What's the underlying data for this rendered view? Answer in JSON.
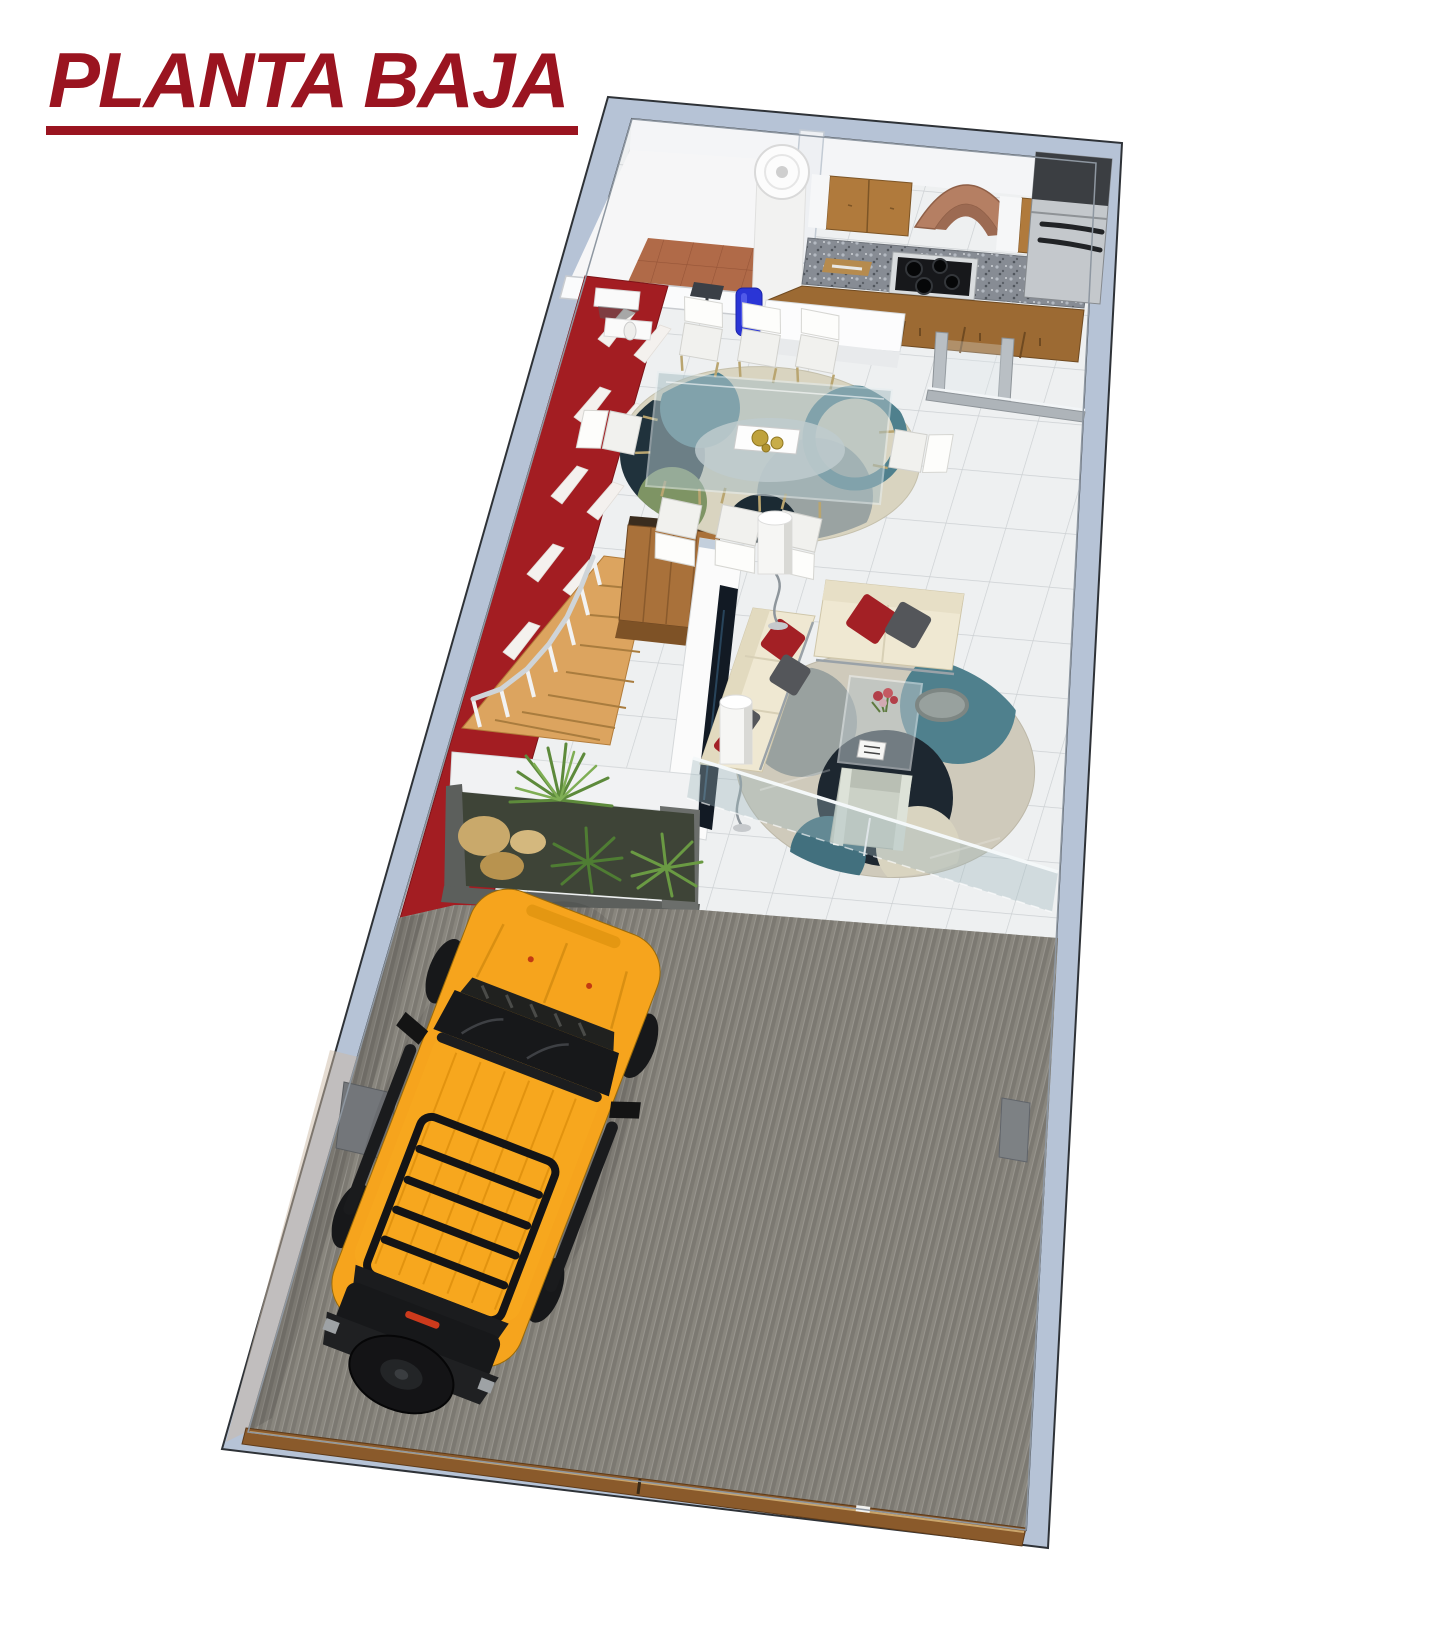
{
  "title": {
    "text": "PLANTA BAJA"
  },
  "palette": {
    "title_red": "#9a1420",
    "wall_cap": "#b6c3d6",
    "wall_face": "#f4f5f7",
    "accent_red": "#a31d22",
    "terracotta_floor": "#b06a48",
    "tile_floor": "#eef0f1",
    "tile_line": "#c6cacd",
    "garage_floor": "#8f8c85",
    "garage_stripe_dark": "#76736b",
    "door_wood": "#8a5a2b",
    "wood_cabinet": "#b07a3c",
    "wood_cabinet_dark": "#9c6a33",
    "granite_counter": "#878c94",
    "hood_terracotta": "#b57f63",
    "fridge_steel": "#c4c8cc",
    "stair_wood": "#dca45f",
    "wardrobe_wood": "#a9713a",
    "sofa_cream": "#efe8d2",
    "pillow_red": "#a32025",
    "pillow_gray": "#54565a",
    "rug_dining_base": "#d9d4c0",
    "rug_living_base": "#cfcabb",
    "rug_teal": "#4f808d",
    "rug_navy": "#1d2b33",
    "rug_gray": "#9aa3a2",
    "glass_tint": "#9fb6bd",
    "suv_yellow": "#f6a41d",
    "suv_black": "#17181a",
    "plant_green": "#5d8a3b",
    "planter_gray": "#5c5f5c"
  },
  "scene": {
    "rooms": [
      "garage",
      "living-room",
      "dining-room",
      "kitchen",
      "utility-room",
      "stairs",
      "planter"
    ],
    "objects": [
      "yellow-suv",
      "glass-dining-table",
      "dining-chairs",
      "cream-sofas",
      "coffee-table",
      "floor-lamps",
      "tv-panel",
      "wardrobe",
      "stove",
      "range-hood",
      "refrigerator",
      "water-heater",
      "water-jug",
      "glass-balustrade",
      "garage-gate",
      "palm-plants"
    ]
  }
}
